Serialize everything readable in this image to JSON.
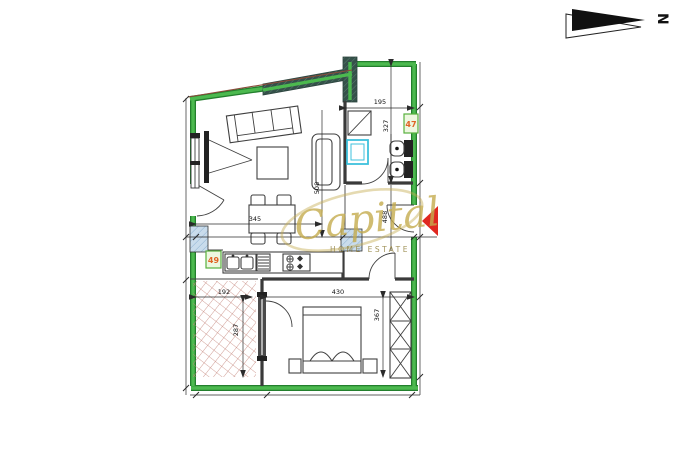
{
  "north": {
    "label": "N"
  },
  "watermark": {
    "brand": "Capital",
    "tagline": "HOME ESTATE"
  },
  "unit_badges": {
    "bathroom": "47",
    "kitchen": "49"
  },
  "dims": {
    "bathroom_width": "195",
    "bathroom_height": "327",
    "living_depth": "508",
    "hall_depth": "488",
    "dining_width": "345",
    "terrace_width": "192",
    "terrace_depth": "287",
    "bedroom_width": "430",
    "bedroom_depth": "367"
  },
  "colors": {
    "wall": "#4cb94f",
    "wall_edge": "#237f2d",
    "hatch_dark": "#35514a",
    "hatch_line": "#5a7d70",
    "cyan": "#3ec1dc",
    "shaft_fill": "#c9dcec",
    "shaft_line": "#7fa8cc",
    "tile": "#c5857a",
    "red": "#e02820",
    "gold": "#c5ac4e",
    "gold_dark": "#8c7a33",
    "badge_fill": "#edf7e0",
    "badge_border": "#58b13e",
    "badge_text": "#e06325"
  }
}
